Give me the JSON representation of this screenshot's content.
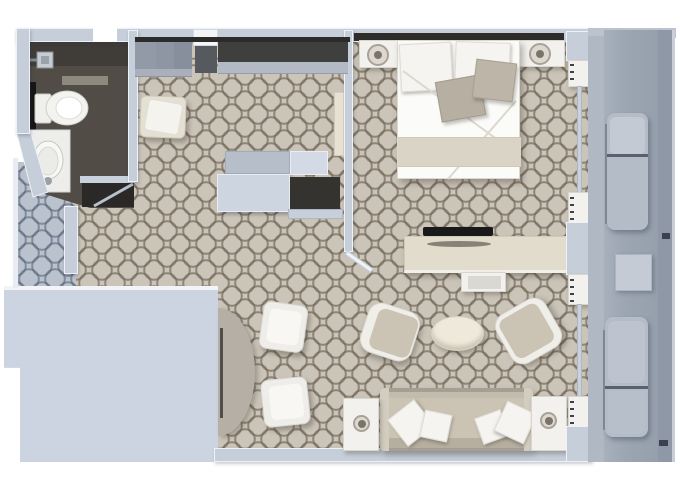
{
  "meta": {
    "title": "Cruise suite floor plan - top-down 3D render",
    "canvas_width": 680,
    "canvas_height": 486,
    "visible_text": "none"
  },
  "palette": {
    "background": "#ffffff",
    "wall": "#c6ceda",
    "wall_outline": "#eef1f6",
    "wall_block": "#ccd4e2",
    "carpet_base": "#cbc4b8",
    "corridor_base": "#bac2cd",
    "bathroom_floor": "#514c46",
    "bathroom_dark": "#2a2927",
    "wardrobe_dark": "#3f403e",
    "headboard_dark": "#2e2d2a",
    "tv_black": "#19191b",
    "balcony_deck": "#9ca6b2",
    "balcony_rail": "#8e98a7",
    "furn_white": "#f2f1ed",
    "furn_beige": "#cbc4b5",
    "bed_white": "#fbfbf9",
    "bed_band": "#dad4c6",
    "pillow_gray": "#b7afa2",
    "table_cream": "#efe9db"
  },
  "rooms": [
    {
      "id": "bathroom",
      "label": "Bathroom",
      "furniture": [
        "shower head",
        "toilet",
        "corner vanity with oval sink"
      ]
    },
    {
      "id": "wardrobe-room",
      "label": "Walk-in wardrobe / dressing area",
      "furniture": [
        "wardrobe closets",
        "ottoman stool",
        "dresser blocks",
        "storage recess"
      ]
    },
    {
      "id": "bedroom",
      "label": "Bedroom",
      "furniture": [
        "double bed",
        "left nightstand with lamp",
        "right nightstand with lamp",
        "TV console",
        "flat TV"
      ]
    },
    {
      "id": "living-room",
      "label": "Living room",
      "furniture": [
        "sofa with four pillows",
        "left armchair",
        "right armchair",
        "oval coffee table",
        "left side table with lamp",
        "right side table with lamp",
        "half-round dining table",
        "two dining chairs"
      ]
    },
    {
      "id": "balcony",
      "label": "Private balcony",
      "furniture": [
        "upper lounger",
        "balcony table",
        "lower lounger"
      ]
    },
    {
      "id": "corridor",
      "label": "Entry corridor",
      "furniture": []
    }
  ]
}
